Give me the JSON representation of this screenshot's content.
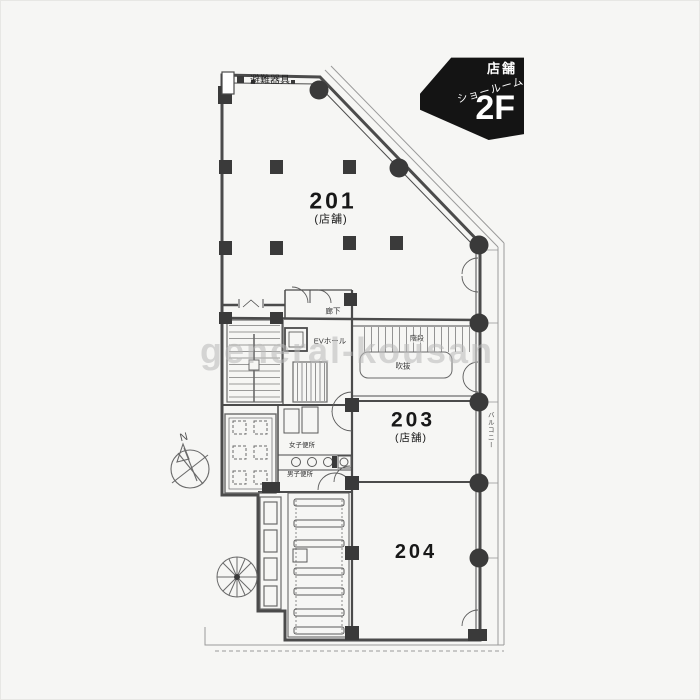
{
  "plan": {
    "corner_label": {
      "use": "店舗",
      "use2": "ショールーム",
      "floor": "2F"
    },
    "rooms": {
      "r201": {
        "number": "201",
        "type": "(店舗)"
      },
      "r203": {
        "number": "203",
        "type": "(店舗)"
      },
      "r204": {
        "number": "204"
      }
    },
    "labels": {
      "evacuation": "避難器具",
      "corridor": "廊下",
      "ev_hall": "EVホール",
      "stairs": "階段",
      "void": "吹抜",
      "womens_toilet": "女子便所",
      "mens_toilet": "男子便所",
      "balcony": "バルコニー",
      "north": "N"
    },
    "watermark": "general-kousan",
    "colors": {
      "line": "#4b4b4b",
      "column": "#3a3a3a",
      "label_bg": "#141414",
      "label_fg": "#ffffff",
      "watermark": "#b9b9b9",
      "paper": "#f6f6f4"
    }
  }
}
